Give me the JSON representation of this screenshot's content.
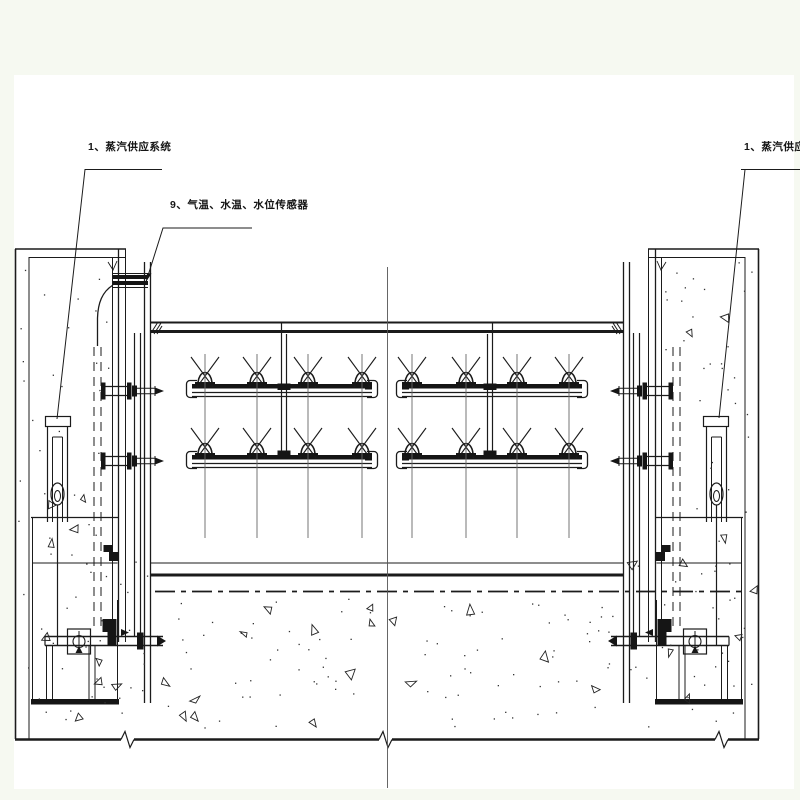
{
  "drawing": {
    "callouts": {
      "steam_supply_left": "1、蒸汽供应系统",
      "sensors": "9、气温、水温、水位传感器",
      "steam_supply_right": "1、蒸汽供应系统"
    },
    "colors": {
      "paper": "#ffffff",
      "margin_tint": "#f6f9f1",
      "ink": "#1b1b1b"
    }
  }
}
